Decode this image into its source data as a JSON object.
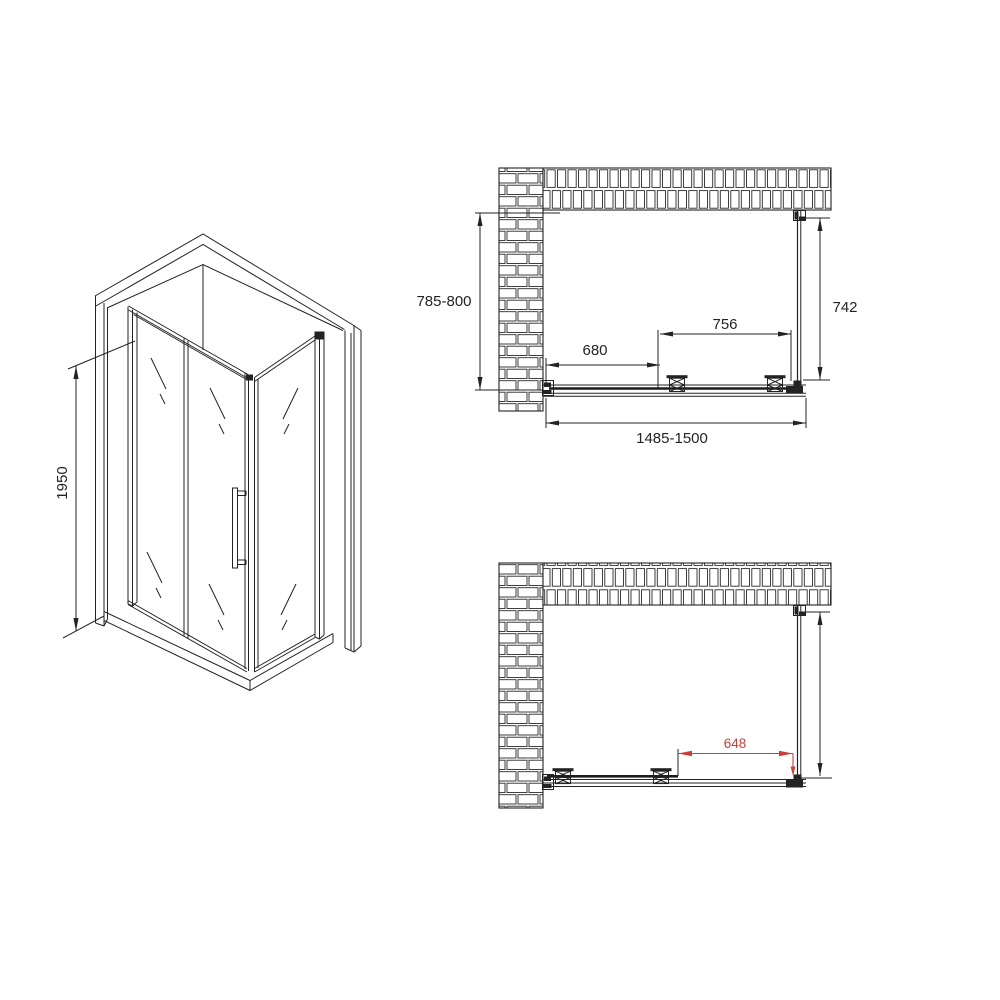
{
  "page": {
    "title": "Shower enclosure dimensional drawing",
    "background": "#ffffff"
  },
  "drawing": {
    "line_color": "#232323",
    "accent_red": "#c9403a",
    "views": {
      "isometric": {
        "label": "isometric view of corner shower enclosure",
        "dimensions": {
          "height": "1950"
        }
      },
      "plan_closed": {
        "label": "plan view, sliding door closed",
        "dimensions": {
          "depth_range": "785-800",
          "fixed_segment": "680",
          "door_opening": "756",
          "side_panel": "742",
          "width_range": "1485-1500"
        }
      },
      "plan_open": {
        "label": "plan view, sliding door open",
        "dimensions": {
          "open_clearance": "648"
        }
      }
    }
  }
}
